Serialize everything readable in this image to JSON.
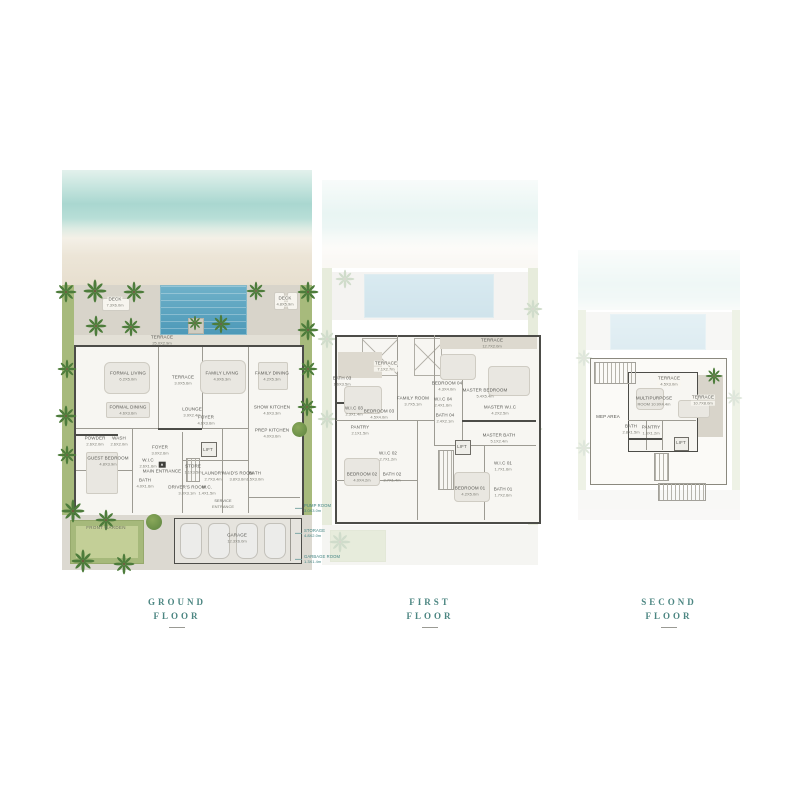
{
  "palette": {
    "title_teal": "#4c8682",
    "callout_teal": "#3f8280",
    "wall": "#4c4c48",
    "pool_blue": "#559dbb",
    "greenery": "#a7ba7c",
    "sea": "#abd7d0",
    "sand": "#e8e0d0",
    "deck": "#d8d4ca"
  },
  "floors": [
    {
      "id": "ground",
      "title_line1": "GROUND",
      "title_line2": "FLOOR",
      "rooms": [
        {
          "name": "deck-left-label",
          "kind": "pill",
          "label": "DECK",
          "dims": "7.3X6.0m",
          "x": 53,
          "y": 132
        },
        {
          "name": "deck-right-label",
          "kind": "pill",
          "label": "DECK",
          "dims": "4.8X5.9m",
          "x": 223,
          "y": 131
        },
        {
          "name": "terrace-strip-label",
          "label": "TERRACE",
          "dims": "25.0X2.9m",
          "x": 100,
          "y": 170
        },
        {
          "name": "formal-living-label",
          "label": "FORMAL LIVING",
          "dims": "6.2X5.0m",
          "x": 66,
          "y": 206
        },
        {
          "name": "terrace-mid-label",
          "label": "TERRACE",
          "dims": "3.0X5.6m",
          "x": 121,
          "y": 210
        },
        {
          "name": "family-living-label",
          "label": "FAMILY LIVING",
          "dims": "4.9X6.3m",
          "x": 160,
          "y": 206
        },
        {
          "name": "family-dining-label",
          "label": "FAMILY DINING",
          "dims": "4.2X5.3m",
          "x": 210,
          "y": 206
        },
        {
          "name": "formal-dining-label",
          "label": "FORMAL DINING",
          "dims": "4.6X3.6m",
          "x": 66,
          "y": 240
        },
        {
          "name": "lounge-label",
          "label": "LOUNGE",
          "dims": "3.9X2.4m",
          "x": 130,
          "y": 242
        },
        {
          "name": "foyer-label",
          "label": "FOYER",
          "dims": "4.6X3.6m",
          "x": 144,
          "y": 250
        },
        {
          "name": "show-kitchen-label",
          "label": "SHOW KITCHEN",
          "dims": "4.6X3.3m",
          "x": 210,
          "y": 240
        },
        {
          "name": "prep-kitchen-label",
          "label": "PREP KITCHEN",
          "dims": "4.0X3.6m",
          "x": 210,
          "y": 263
        },
        {
          "name": "powder-label",
          "label": "POWDER",
          "dims": "2.6X2.0m",
          "x": 33,
          "y": 271
        },
        {
          "name": "wash-label",
          "label": "WASH",
          "dims": "2.6X2.0m",
          "x": 57,
          "y": 271
        },
        {
          "name": "guest-bedroom-label",
          "label": "GUEST BEDROOM",
          "dims": "4.8X3.9m",
          "x": 46,
          "y": 291
        },
        {
          "name": "wic-label",
          "label": "W.I.C",
          "dims": "2.6X1.6m",
          "x": 86,
          "y": 293
        },
        {
          "name": "bath-label",
          "label": "BATH",
          "dims": "4.0X1.6m",
          "x": 83,
          "y": 313
        },
        {
          "name": "entry-foyer-label",
          "label": "FOYER",
          "dims": "3.0X2.6m",
          "x": 98,
          "y": 280
        },
        {
          "name": "main-entrance-label",
          "kind": "entrance",
          "label": "MAIN ENTRANCE",
          "x": 100,
          "y": 298
        },
        {
          "name": "lift-label",
          "label": "LIFT",
          "x": 146,
          "y": 280
        },
        {
          "name": "store-label",
          "label": "STORE",
          "dims": "1.1X3.5m",
          "x": 131,
          "y": 299
        },
        {
          "name": "laundry-label",
          "label": "LAUNDRY",
          "dims": "2.7X3.4m",
          "x": 151,
          "y": 306
        },
        {
          "name": "drivers-room-label",
          "label": "DRIVER'S ROOM",
          "dims": "3.0X3.1m",
          "x": 125,
          "y": 320
        },
        {
          "name": "wc-label",
          "label": "W.C.",
          "dims": "1.4X1.5m",
          "x": 145,
          "y": 320
        },
        {
          "name": "maids-room-label",
          "label": "MAID'S ROOM",
          "dims": "3.8X3.6m",
          "x": 176,
          "y": 306
        },
        {
          "name": "maids-bath-label",
          "label": "BATH",
          "dims": "1.5X3.0m",
          "x": 193,
          "y": 306
        },
        {
          "name": "service-entrance-label",
          "kind": "small",
          "label": "SERVICE",
          "dims": "ENTRANCE",
          "x": 161,
          "y": 334
        },
        {
          "name": "front-garden-label",
          "kind": "area",
          "label": "FRONT GARDEN",
          "x": 44,
          "y": 358
        },
        {
          "name": "garage-label",
          "label": "GARAGE",
          "dims": "12.3X6.0m",
          "x": 175,
          "y": 368
        },
        {
          "name": "pump-room-callout",
          "kind": "callout",
          "label": "PUMP ROOM",
          "dims": "3.0X3.0m",
          "x": 242,
          "y": 338
        },
        {
          "name": "storage-callout",
          "kind": "callout",
          "label": "STORAGE",
          "dims": "4.8X2.0m",
          "x": 242,
          "y": 363
        },
        {
          "name": "garbage-room-callout",
          "kind": "callout",
          "label": "GARBAGE ROOM",
          "dims": "1.3X1.4m",
          "x": 242,
          "y": 389
        }
      ]
    },
    {
      "id": "first",
      "title_line1": "FIRST",
      "title_line2": "FLOOR",
      "rooms": [
        {
          "name": "terrace-left-label",
          "kind": "pill",
          "label": "TERRACE",
          "dims": "7.1X2.7m",
          "x": 64,
          "y": 186
        },
        {
          "name": "terrace-right-label",
          "label": "TERRACE",
          "dims": "12.7X2.0m",
          "x": 170,
          "y": 163
        },
        {
          "name": "bedroom04-label",
          "label": "BEDROOM 04",
          "dims": "4.3X4.0m",
          "x": 125,
          "y": 206
        },
        {
          "name": "master-bedroom-label",
          "label": "MASTER BEDROOM",
          "dims": "5.4X5.4m",
          "x": 163,
          "y": 213
        },
        {
          "name": "bath03-label",
          "label": "BATH 03",
          "dims": "1.6X3.5m",
          "x": 20,
          "y": 201
        },
        {
          "name": "wic03-label",
          "label": "W.I.C 03",
          "dims": "2.3X1.4m",
          "x": 32,
          "y": 231
        },
        {
          "name": "bedroom03-label",
          "label": "BEDROOM 03",
          "dims": "4.5X4.0m",
          "x": 57,
          "y": 234
        },
        {
          "name": "family-room-label",
          "label": "FAMILY ROOM",
          "dims": "3.7X5.1m",
          "x": 91,
          "y": 221
        },
        {
          "name": "wic04-label",
          "label": "W.I.C 04",
          "dims": "2.4X1.6m",
          "x": 121,
          "y": 222
        },
        {
          "name": "bath04-label",
          "label": "BATH 04",
          "dims": "2.4X2.1m",
          "x": 123,
          "y": 238
        },
        {
          "name": "master-wic-label",
          "label": "MASTER W.I.C",
          "dims": "4.2X2.5m",
          "x": 178,
          "y": 230
        },
        {
          "name": "master-bath-label",
          "label": "MASTER BATH",
          "dims": "5.1X2.4m",
          "x": 177,
          "y": 258
        },
        {
          "name": "pantry-label",
          "label": "PANTRY",
          "dims": "2.1X1.5m",
          "x": 38,
          "y": 250
        },
        {
          "name": "bedroom02-label",
          "label": "BEDROOM 02",
          "dims": "4.0X4.2m",
          "x": 40,
          "y": 297
        },
        {
          "name": "wic02-label",
          "label": "W.I.C 02",
          "dims": "2.7X1.2m",
          "x": 66,
          "y": 276
        },
        {
          "name": "bath02-label",
          "label": "BATH 02",
          "dims": "2.7X1.4m",
          "x": 70,
          "y": 297
        },
        {
          "name": "lift-label",
          "label": "LIFT",
          "x": 140,
          "y": 267
        },
        {
          "name": "bedroom01-label",
          "label": "BEDROOM 01",
          "dims": "4.2X5.0m",
          "x": 148,
          "y": 311
        },
        {
          "name": "wic01-label",
          "label": "W.I.C 01",
          "dims": "1.7X1.6m",
          "x": 181,
          "y": 286
        },
        {
          "name": "bath01-label",
          "label": "BATH 01",
          "dims": "1.7X2.6m",
          "x": 181,
          "y": 312
        }
      ]
    },
    {
      "id": "second",
      "title_line1": "SECOND",
      "title_line2": "FLOOR",
      "rooms": [
        {
          "name": "terrace-small-label",
          "kind": "pill",
          "label": "TERRACE",
          "dims": "4.5X3.0m",
          "x": 91,
          "y": 131
        },
        {
          "name": "terrace-large-label",
          "kind": "pill",
          "label": "TERRACE",
          "dims": "10.7X8.0m",
          "x": 125,
          "y": 150
        },
        {
          "name": "multipurpose-room-label",
          "label": "MULTIPURPOSE",
          "dims": "ROOM 10.9X4.4m",
          "x": 76,
          "y": 151
        },
        {
          "name": "mep-area-label",
          "label": "MEP AREA",
          "x": 30,
          "y": 167
        },
        {
          "name": "bath-label",
          "label": "BATH",
          "dims": "2.8X1.5m",
          "x": 53,
          "y": 179
        },
        {
          "name": "pantry-label",
          "label": "PANTRY",
          "dims": "1.6X1.2m",
          "x": 73,
          "y": 180
        },
        {
          "name": "lift-label",
          "label": "LIFT",
          "x": 103,
          "y": 193
        }
      ]
    }
  ]
}
